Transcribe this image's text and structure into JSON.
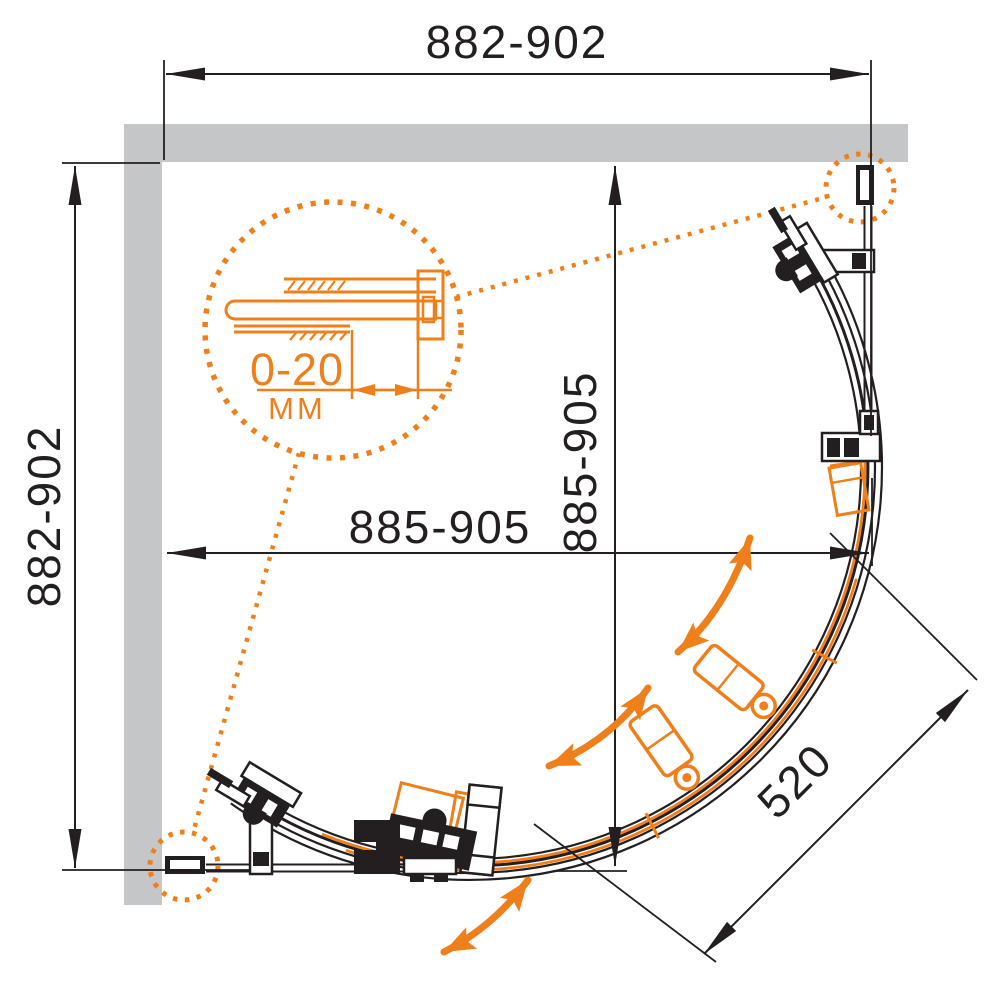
{
  "colors": {
    "accent": "#EF7F1A",
    "line": "#231F20",
    "wall": "#C5C6C8"
  },
  "dimensions": {
    "overall_width": "882-902",
    "overall_height": "882-902",
    "inner_width": "885-905",
    "inner_height": "885-905",
    "front_radius": "520"
  },
  "detail_callout": {
    "range": "0-20",
    "unit": "MM"
  },
  "icons": {
    "dimension_arrow": "filled-triangle-arrowhead",
    "door_swing_arrow": "curved-double-headed-arrow",
    "detail_circle": "dotted-magnifier-circle"
  }
}
